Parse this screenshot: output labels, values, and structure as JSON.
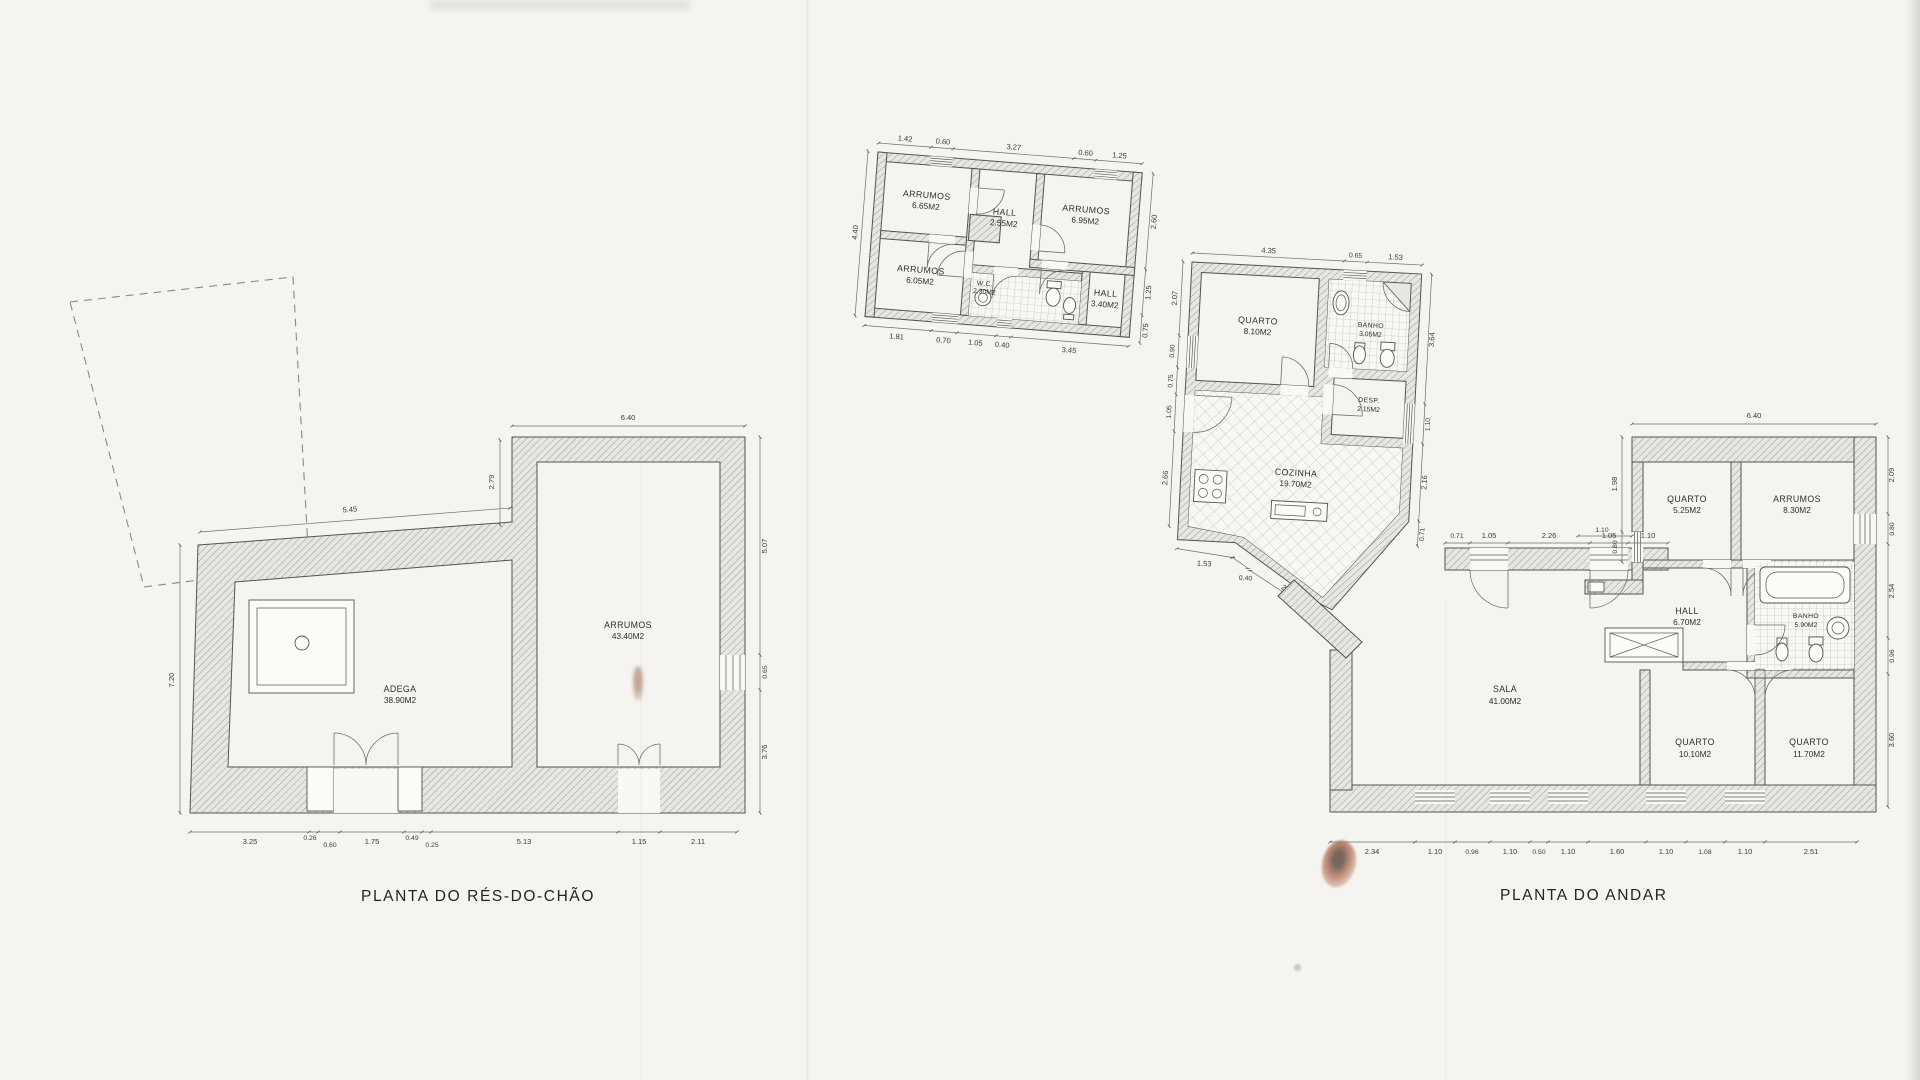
{
  "titles": {
    "ground": "PLANTA DO RÉS-DO-CHÃO",
    "first": "PLANTA DO ANDAR"
  },
  "colors": {
    "paper": "#f5f4f0",
    "ink": "#3a3a36",
    "stain": "#a4674c"
  },
  "annex": {
    "rooms": [
      {
        "name": "ARRUMOS",
        "area": "6.65M2"
      },
      {
        "name": "ARRUMOS",
        "area": "6.95M2"
      },
      {
        "name": "HALL",
        "area": "2.55M2"
      },
      {
        "name": "ARRUMOS",
        "area": "6.05M2"
      },
      {
        "name": "W.C.",
        "area": "2.30M2"
      },
      {
        "name": "HALL",
        "area": "3.40M2"
      }
    ],
    "dims": {
      "top": [
        "1.42",
        "0.60",
        "3.27",
        "0.60",
        "1.25"
      ],
      "left": [
        "4.40"
      ],
      "right": [
        "2.60",
        "1.25",
        "0.75"
      ],
      "bottom": [
        "1.81",
        "0.70",
        "1.05",
        "0.40",
        "3.45"
      ]
    }
  },
  "ground": {
    "rooms": [
      {
        "name": "ADEGA",
        "area": "38.90M2"
      },
      {
        "name": "ARRUMOS",
        "area": "43.40M2"
      }
    ],
    "dims": {
      "top_left": "5.45",
      "top_right": "6.40",
      "left": "7.20",
      "notch": "2.79",
      "right": [
        "5.07",
        "0.65",
        "3.76"
      ],
      "bottom": [
        "3.25",
        "0.26",
        "0.60",
        "1.75",
        "0.49",
        "0.25",
        "5.13",
        "1.15",
        "2.11"
      ]
    }
  },
  "first": {
    "rooms": [
      {
        "name": "QUARTO",
        "area": "8.10M2"
      },
      {
        "name": "BANHO",
        "area": "3.05M2"
      },
      {
        "name": "DESP.",
        "area": "2.15M2"
      },
      {
        "name": "COZINHA",
        "area": "19.70M2"
      },
      {
        "name": "QUARTO",
        "area": "5.25M2"
      },
      {
        "name": "ARRUMOS",
        "area": "8.30M2"
      },
      {
        "name": "HALL",
        "area": "6.70M2"
      },
      {
        "name": "BANHO",
        "area": "5.90M2"
      },
      {
        "name": "SALA",
        "area": "41.00M2"
      },
      {
        "name": "QUARTO",
        "area": "10.10M2"
      },
      {
        "name": "QUARTO",
        "area": "11.70M2"
      }
    ],
    "dims": {
      "sec1_top": [
        "4.35",
        "0.65",
        "1.53"
      ],
      "sec1_left": [
        "2.07",
        "0.90",
        "0.75",
        "1.05",
        "2.66"
      ],
      "sec1_right": [
        "3.64",
        "1.10",
        "2.16",
        "0.71"
      ],
      "sec1_diag": [
        "1.53",
        "0.40",
        "2.42"
      ],
      "mid": [
        "0.71",
        "1.05",
        "2.26",
        "1.05",
        "1.10"
      ],
      "sec2_top": [
        "6.40"
      ],
      "sec2_left": [
        "1.98",
        "0.80",
        "1.10"
      ],
      "sec2_right": [
        "2.09",
        "0.80",
        "2.54",
        "0.96",
        "3.60"
      ],
      "bottom": [
        "2.34",
        "1.10",
        "0.96",
        "1.10",
        "0.50",
        "1.10",
        "1.60",
        "1.10",
        "1.08",
        "1.10",
        "2.51"
      ]
    }
  }
}
